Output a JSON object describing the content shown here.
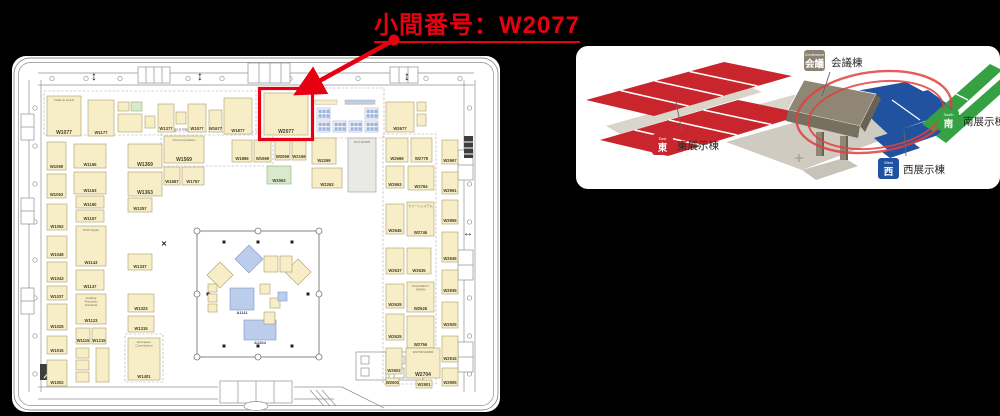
{
  "title": {
    "text": "小間番号：W2077"
  },
  "highlight": {
    "booth_id": "W2077",
    "color": "#e60012"
  },
  "floorplan": {
    "zone_label": "Metrology & Inspection",
    "booth_colors": {
      "beige": "#f7eec7",
      "green": "#d9e9cb",
      "gray": "#e9e9e6",
      "blue": "#bccdeb"
    },
    "booths": [
      {
        "id": "W1077",
        "sub": "Trade & Invest",
        "x": 35,
        "y": 40,
        "w": 34,
        "h": 40
      },
      {
        "id": "W1177",
        "x": 76,
        "y": 44,
        "w": 26,
        "h": 36
      },
      {
        "id": "",
        "x": 106,
        "y": 46,
        "w": 11,
        "h": 9
      },
      {
        "id": "",
        "x": 119,
        "y": 46,
        "w": 11,
        "h": 9,
        "c": "g"
      },
      {
        "id": "",
        "x": 106,
        "y": 58,
        "w": 24,
        "h": 18
      },
      {
        "id": "",
        "x": 133,
        "y": 60,
        "w": 10,
        "h": 12
      },
      {
        "id": "W1377",
        "x": 146,
        "y": 48,
        "w": 16,
        "h": 28
      },
      {
        "id": "",
        "x": 164,
        "y": 56,
        "w": 10,
        "h": 12
      },
      {
        "id": "W1577",
        "x": 176,
        "y": 48,
        "w": 18,
        "h": 28
      },
      {
        "id": "W1677",
        "x": 197,
        "y": 54,
        "w": 13,
        "h": 22
      },
      {
        "id": "W1877",
        "x": 212,
        "y": 42,
        "w": 28,
        "h": 36
      },
      {
        "id": "W2077",
        "x": 252,
        "y": 37,
        "w": 44,
        "h": 42,
        "hl": true
      },
      {
        "id": "W2677",
        "x": 374,
        "y": 46,
        "w": 28,
        "h": 30
      },
      {
        "id": "",
        "x": 405,
        "y": 46,
        "w": 9,
        "h": 9
      },
      {
        "id": "",
        "x": 405,
        "y": 58,
        "w": 9,
        "h": 12
      },
      {
        "id": "W1069",
        "x": 35,
        "y": 86,
        "w": 19,
        "h": 28
      },
      {
        "id": "W1165",
        "x": 62,
        "y": 88,
        "w": 32,
        "h": 24
      },
      {
        "id": "W1369",
        "x": 116,
        "y": 88,
        "w": 34,
        "h": 24
      },
      {
        "id": "W1569",
        "sub": "KLA Corporation",
        "x": 152,
        "y": 80,
        "w": 40,
        "h": 27
      },
      {
        "id": "W1869",
        "x": 220,
        "y": 84,
        "w": 20,
        "h": 22
      },
      {
        "id": "W1969",
        "x": 242,
        "y": 84,
        "w": 17,
        "h": 22
      },
      {
        "id": "W2069",
        "x": 263,
        "y": 84,
        "w": 15,
        "h": 20
      },
      {
        "id": "W2169",
        "x": 280,
        "y": 84,
        "w": 14,
        "h": 20
      },
      {
        "id": "W2269",
        "x": 300,
        "y": 82,
        "w": 24,
        "h": 26
      },
      {
        "id": "",
        "sub": "Tech SHOP",
        "x": 336,
        "y": 82,
        "w": 28,
        "h": 54,
        "c": "gr"
      },
      {
        "id": "W2669",
        "x": 374,
        "y": 82,
        "w": 22,
        "h": 24
      },
      {
        "id": "W2779",
        "x": 399,
        "y": 82,
        "w": 21,
        "h": 24
      },
      {
        "id": "W2967",
        "x": 430,
        "y": 84,
        "w": 16,
        "h": 24
      },
      {
        "id": "W1063",
        "x": 35,
        "y": 118,
        "w": 19,
        "h": 24
      },
      {
        "id": "W1163",
        "x": 62,
        "y": 116,
        "w": 32,
        "h": 22
      },
      {
        "id": "W1363",
        "x": 116,
        "y": 116,
        "w": 34,
        "h": 24
      },
      {
        "id": "W1567",
        "x": 152,
        "y": 111,
        "w": 16,
        "h": 18
      },
      {
        "id": "W1767",
        "x": 170,
        "y": 111,
        "w": 22,
        "h": 18
      },
      {
        "id": "W2063",
        "x": 255,
        "y": 110,
        "w": 24,
        "h": 18,
        "c": "g"
      },
      {
        "id": "W2263",
        "x": 300,
        "y": 112,
        "w": 30,
        "h": 20
      },
      {
        "id": "W2663",
        "x": 374,
        "y": 110,
        "w": 18,
        "h": 22
      },
      {
        "id": "W2764",
        "x": 396,
        "y": 110,
        "w": 26,
        "h": 24
      },
      {
        "id": "W2961",
        "x": 430,
        "y": 116,
        "w": 16,
        "h": 22
      },
      {
        "id": "W1052",
        "x": 35,
        "y": 148,
        "w": 20,
        "h": 26
      },
      {
        "id": "W1160",
        "x": 64,
        "y": 140,
        "w": 28,
        "h": 12
      },
      {
        "id": "W1157",
        "x": 64,
        "y": 154,
        "w": 28,
        "h": 12
      },
      {
        "id": "W1257",
        "x": 116,
        "y": 142,
        "w": 24,
        "h": 14
      },
      {
        "id": "W1048",
        "x": 35,
        "y": 180,
        "w": 20,
        "h": 22
      },
      {
        "id": "W1143",
        "sub": "PTW Japan",
        "x": 64,
        "y": 170,
        "w": 30,
        "h": 40
      },
      {
        "id": "W1043",
        "x": 35,
        "y": 206,
        "w": 20,
        "h": 20
      },
      {
        "id": "W2645",
        "x": 374,
        "y": 148,
        "w": 18,
        "h": 30
      },
      {
        "id": "W2746",
        "sub": "クリーンシステム",
        "x": 395,
        "y": 146,
        "w": 27,
        "h": 34
      },
      {
        "id": "W2955",
        "x": 430,
        "y": 144,
        "w": 16,
        "h": 24
      },
      {
        "id": "W2945",
        "x": 430,
        "y": 176,
        "w": 16,
        "h": 30
      },
      {
        "id": "W1037",
        "x": 35,
        "y": 230,
        "w": 20,
        "h": 14
      },
      {
        "id": "W1137",
        "x": 64,
        "y": 214,
        "w": 28,
        "h": 20
      },
      {
        "id": "W1337",
        "x": 116,
        "y": 198,
        "w": 24,
        "h": 16
      },
      {
        "id": "W2637",
        "x": 374,
        "y": 192,
        "w": 18,
        "h": 26
      },
      {
        "id": "W2635",
        "x": 395,
        "y": 192,
        "w": 24,
        "h": 26
      },
      {
        "id": "W2935",
        "x": 430,
        "y": 214,
        "w": 16,
        "h": 24
      },
      {
        "id": "W1025",
        "x": 35,
        "y": 248,
        "w": 20,
        "h": 26
      },
      {
        "id": "W1123",
        "sub": "Guiding Precision Industrial",
        "x": 64,
        "y": 238,
        "w": 30,
        "h": 30
      },
      {
        "id": "W1323",
        "x": 116,
        "y": 238,
        "w": 26,
        "h": 18
      },
      {
        "id": "W2629",
        "x": 374,
        "y": 228,
        "w": 18,
        "h": 24
      },
      {
        "id": "W2626",
        "sub": "POLATECH JAPAN",
        "x": 395,
        "y": 226,
        "w": 27,
        "h": 30
      },
      {
        "id": "W2925",
        "x": 430,
        "y": 246,
        "w": 16,
        "h": 26
      },
      {
        "id": "W1015",
        "x": 35,
        "y": 280,
        "w": 20,
        "h": 18
      },
      {
        "id": "W1115",
        "x": 64,
        "y": 272,
        "w": 14,
        "h": 16
      },
      {
        "id": "W1215",
        "x": 80,
        "y": 272,
        "w": 14,
        "h": 16
      },
      {
        "id": "W1315",
        "x": 116,
        "y": 260,
        "w": 26,
        "h": 16
      },
      {
        "id": "W2625",
        "x": 374,
        "y": 258,
        "w": 18,
        "h": 26
      },
      {
        "id": "W2756",
        "x": 395,
        "y": 260,
        "w": 27,
        "h": 32
      },
      {
        "id": "W2915",
        "x": 430,
        "y": 280,
        "w": 16,
        "h": 26
      },
      {
        "id": "W1002",
        "x": 35,
        "y": 304,
        "w": 20,
        "h": 26
      },
      {
        "id": "W1401",
        "sub": "European Commission",
        "x": 116,
        "y": 282,
        "w": 32,
        "h": 42
      },
      {
        "id": "W2602",
        "x": 374,
        "y": 292,
        "w": 16,
        "h": 26
      },
      {
        "id": "W2704",
        "sub": "W2708 W2806",
        "x": 394,
        "y": 292,
        "w": 34,
        "h": 30
      },
      {
        "id": "W2905",
        "x": 430,
        "y": 312,
        "w": 16,
        "h": 18
      },
      {
        "id": "W2601",
        "x": 374,
        "y": 322,
        "w": 13,
        "h": 8
      },
      {
        "id": "W2901",
        "x": 404,
        "y": 324,
        "w": 16,
        "h": 8
      },
      {
        "id": "",
        "x": 64,
        "y": 292,
        "w": 13,
        "h": 10
      },
      {
        "id": "",
        "x": 64,
        "y": 304,
        "w": 13,
        "h": 10
      },
      {
        "id": "",
        "x": 64,
        "y": 316,
        "w": 13,
        "h": 10
      },
      {
        "id": "",
        "x": 84,
        "y": 292,
        "w": 13,
        "h": 34
      }
    ],
    "cluster": {
      "groups": [
        [
          305,
          52
        ],
        [
          305,
          65
        ],
        [
          321,
          65
        ],
        [
          337,
          65
        ],
        [
          353,
          65
        ],
        [
          353,
          52
        ]
      ],
      "strips": [
        [
          303,
          44,
          22,
          "beige"
        ],
        [
          333,
          44,
          30,
          "blue"
        ]
      ]
    },
    "courtyard": {
      "x": 185,
      "y": 175,
      "w": 122,
      "h": 126,
      "diamonds": [
        {
          "cx": 237,
          "cy": 203,
          "r": 14,
          "c": "b"
        },
        {
          "cx": 208,
          "cy": 219,
          "r": 13,
          "c": "y"
        },
        {
          "cx": 286,
          "cy": 216,
          "r": 13,
          "c": "y"
        }
      ],
      "rects": [
        {
          "id": "A1111",
          "x": 218,
          "y": 232,
          "w": 24,
          "h": 22,
          "c": "b"
        },
        {
          "id": "A1204",
          "x": 232,
          "y": 264,
          "w": 32,
          "h": 20,
          "c": "b"
        },
        {
          "id": "",
          "x": 252,
          "y": 200,
          "w": 14,
          "h": 16,
          "c": "y"
        },
        {
          "id": "",
          "x": 268,
          "y": 200,
          "w": 12,
          "h": 16,
          "c": "y"
        },
        {
          "id": "",
          "x": 248,
          "y": 228,
          "w": 10,
          "h": 10,
          "c": "y"
        },
        {
          "id": "",
          "x": 258,
          "y": 242,
          "w": 10,
          "h": 10,
          "c": "y"
        },
        {
          "id": "",
          "x": 266,
          "y": 236,
          "w": 9,
          "h": 9,
          "c": "b"
        },
        {
          "id": "",
          "x": 196,
          "y": 228,
          "w": 9,
          "h": 8,
          "c": "y"
        },
        {
          "id": "",
          "x": 196,
          "y": 238,
          "w": 9,
          "h": 8,
          "c": "y"
        },
        {
          "id": "",
          "x": 196,
          "y": 248,
          "w": 9,
          "h": 8,
          "c": "y"
        },
        {
          "id": "",
          "x": 252,
          "y": 256,
          "w": 11,
          "h": 12,
          "c": "y"
        }
      ]
    }
  },
  "venue_map": {
    "highlight_color": "#e0413f",
    "buildings": [
      {
        "key": "east",
        "label": "東展示棟",
        "badge": "東",
        "badge_sub": "East",
        "color": "#c8262c"
      },
      {
        "key": "west",
        "label": "西展示棟",
        "badge": "西",
        "badge_sub": "West",
        "color": "#2152a0"
      },
      {
        "key": "south",
        "label": "南展示棟",
        "badge": "南",
        "badge_sub": "South",
        "color": "#35a143"
      },
      {
        "key": "conference",
        "label": "会議棟",
        "badge": "会議",
        "badge_sub": "Conference",
        "color": "#8b8272"
      }
    ]
  }
}
